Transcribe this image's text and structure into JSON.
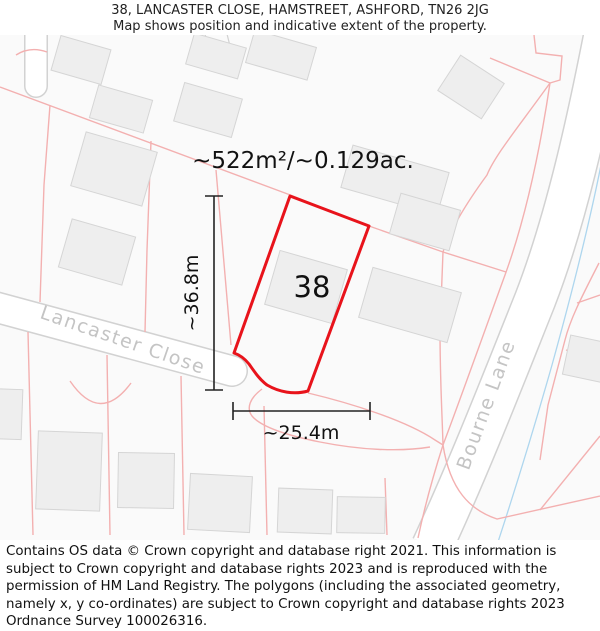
{
  "header": {
    "title": "38, LANCASTER CLOSE, HAMSTREET, ASHFORD, TN26 2JG",
    "subtitle": "Map shows position and indicative extent of the property."
  },
  "map": {
    "area_label": "~522m²/~0.129ac.",
    "plot_number": "38",
    "dim_vertical": "~36.8m",
    "dim_horizontal": "~25.4m",
    "streets": {
      "lancaster": "Lancaster Close",
      "bourne": "Bourne Lane"
    },
    "colors": {
      "plot_outline": "#e8131b",
      "parcel_line": "#f3b0b0",
      "road_edge": "#d2d2d2",
      "building_fill": "#eeeeee",
      "building_stroke": "#d5d5d5",
      "water_line": "#aed6ee",
      "street_label": "#c4c4c4"
    }
  },
  "footer": {
    "text": "Contains OS data © Crown copyright and database right 2021. This information is subject to Crown copyright and database rights 2023 and is reproduced with the permission of HM Land Registry. The polygons (including the associated geometry, namely x, y co-ordinates) are subject to Crown copyright and database rights 2023 Ordnance Survey 100026316."
  }
}
